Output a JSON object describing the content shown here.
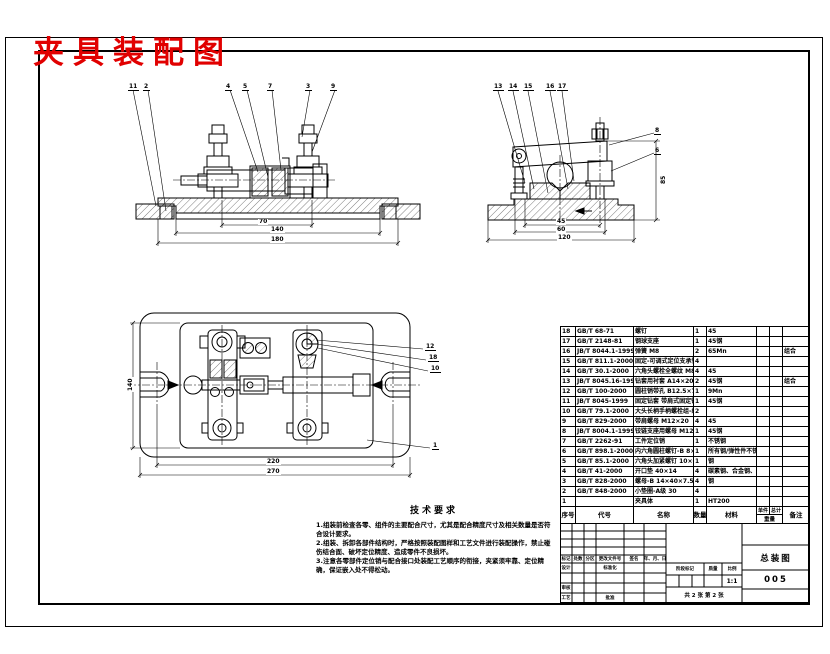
{
  "title": "夹具装配图",
  "title_color": "#e10000",
  "tech": {
    "heading": "技术要求",
    "items": [
      "1.组装前检查各零、组件的主要配合尺寸，尤其是配合精度尺寸及相关数量是否符合设计要求。",
      "2.组装、拆卸各部件结构时，严格按照装配图样和工艺文件进行装配操作，禁止碰伤结合面、破坏定位精度、造成零件不良损坏。",
      "3.注意各零部件定位销与配合接口处装配工艺顺序的衔接，夹紧须牢靠、定位精确，保证嵌入处不得松动。"
    ]
  },
  "bom": {
    "header": {
      "seq": "序号",
      "code": "代号",
      "name": "名称",
      "qty": "数量",
      "material": "材料",
      "unit": "单件",
      "total": "总计",
      "weight": "重量",
      "remark": "备注"
    },
    "rows": [
      {
        "seq": "18",
        "code": "GB/T 68-71",
        "name": "螺钉",
        "qty": "1",
        "material": "45",
        "unit": "",
        "total": "",
        "remark": ""
      },
      {
        "seq": "17",
        "code": "GB/T 2148-81",
        "name": "钢球支座",
        "qty": "1",
        "material": "45钢",
        "unit": "",
        "total": "",
        "remark": ""
      },
      {
        "seq": "16",
        "code": "JB/T 8044.1-1999",
        "name": "弹簧 M8",
        "qty": "2",
        "material": "65Mn",
        "unit": "",
        "total": "",
        "remark": "组合"
      },
      {
        "seq": "15",
        "code": "GB/T 811.1-2000",
        "name": "固定-可调式定位支承钉 B6×30",
        "qty": "4",
        "material": "",
        "unit": "",
        "total": "",
        "remark": ""
      },
      {
        "seq": "14",
        "code": "GB/T 30.1-2000",
        "name": "六角头螺栓全螺纹 M8×35",
        "qty": "4",
        "material": "45",
        "unit": "",
        "total": "",
        "remark": ""
      },
      {
        "seq": "13",
        "code": "JB/T 8045.16-1999",
        "name": "钻套用衬套 A14×20",
        "qty": "2",
        "material": "45钢",
        "unit": "",
        "total": "",
        "remark": "组合"
      },
      {
        "seq": "12",
        "code": "GB/T 100-2000",
        "name": "圆柱销带孔 B12.5×70",
        "qty": "1",
        "material": "9Mn",
        "unit": "",
        "total": "",
        "remark": ""
      },
      {
        "seq": "11",
        "code": "JB/T 8045-1999",
        "name": "固定钻套 带肩式固定钻套",
        "qty": "1",
        "material": "45钢",
        "unit": "",
        "total": "",
        "remark": ""
      },
      {
        "seq": "10",
        "code": "GB/T 79.1-2000",
        "name": "大头长柄手柄螺栓组-组 B8×L",
        "qty": "2",
        "material": "",
        "unit": "",
        "total": "",
        "remark": ""
      },
      {
        "seq": "9",
        "code": "GB/T 829-2000",
        "name": "带肩螺母 M12×20",
        "qty": "4",
        "material": "45",
        "unit": "",
        "total": "",
        "remark": ""
      },
      {
        "seq": "8",
        "code": "JB/T 8004.1-1999",
        "name": "铰链支座用螺母 M12",
        "qty": "1",
        "material": "45钢",
        "unit": "",
        "total": "",
        "remark": ""
      },
      {
        "seq": "7",
        "code": "GB/T 2262-91",
        "name": "工件定位销",
        "qty": "1",
        "material": "不锈钢",
        "unit": "",
        "total": "",
        "remark": ""
      },
      {
        "seq": "6",
        "code": "GB/T 898.1-2000",
        "name": "内六角圆柱螺钉-B 8×16-B",
        "qty": "1",
        "material": "所有钢/弹性件不锈钢",
        "unit": "",
        "total": "",
        "remark": ""
      },
      {
        "seq": "5",
        "code": "GB/T 85.1-2000",
        "name": "六角头加紧螺钉 10×60",
        "qty": "1",
        "material": "钢",
        "unit": "",
        "total": "",
        "remark": ""
      },
      {
        "seq": "4",
        "code": "GB/T 41-2000",
        "name": "开口垫 40×14",
        "qty": "4",
        "material": "碳素钢、合金钢、不锈钢",
        "unit": "",
        "total": "",
        "remark": ""
      },
      {
        "seq": "3",
        "code": "GB/T 828-2000",
        "name": "螺母-B 14×40×7.5×14.5",
        "qty": "4",
        "material": "钢",
        "unit": "",
        "total": "",
        "remark": ""
      },
      {
        "seq": "2",
        "code": "GB/T 848-2000",
        "name": "小垫圈-A级 30",
        "qty": "4",
        "material": "",
        "unit": "",
        "total": "",
        "remark": ""
      },
      {
        "seq": "1",
        "code": "",
        "name": "夹具体",
        "qty": "1",
        "material": "HT200",
        "unit": "",
        "total": "",
        "remark": ""
      }
    ]
  },
  "title_block": {
    "rev_cols": [
      "标记",
      "处数",
      "分区",
      "更改文件号",
      "签名",
      "年、月、日"
    ],
    "labels": {
      "design": "设计",
      "standardization": "标准化",
      "check": "审核",
      "process": "工艺",
      "approve": "批准",
      "stage": "阶段标记",
      "weight": "质量",
      "scale": "比例"
    },
    "scale_value": "1:1",
    "weight_value": "",
    "sheet_info": "共 2 张  第 2 张",
    "drawing_name": "总装图",
    "drawing_no": "005"
  },
  "annotations": {
    "balloons": [
      {
        "n": "11",
        "x": 128,
        "y": 83
      },
      {
        "n": "2",
        "x": 143,
        "y": 83
      },
      {
        "n": "4",
        "x": 225,
        "y": 83
      },
      {
        "n": "5",
        "x": 242,
        "y": 83
      },
      {
        "n": "7",
        "x": 267,
        "y": 83
      },
      {
        "n": "3",
        "x": 305,
        "y": 83
      },
      {
        "n": "9",
        "x": 330,
        "y": 83
      },
      {
        "n": "13",
        "x": 493,
        "y": 83
      },
      {
        "n": "14",
        "x": 508,
        "y": 83
      },
      {
        "n": "15",
        "x": 523,
        "y": 83
      },
      {
        "n": "16",
        "x": 545,
        "y": 83
      },
      {
        "n": "17",
        "x": 557,
        "y": 83
      },
      {
        "n": "8",
        "x": 654,
        "y": 127
      },
      {
        "n": "6",
        "x": 654,
        "y": 147
      },
      {
        "n": "12",
        "x": 425,
        "y": 343
      },
      {
        "n": "18",
        "x": 428,
        "y": 354
      },
      {
        "n": "10",
        "x": 430,
        "y": 365
      },
      {
        "n": "1",
        "x": 432,
        "y": 442
      }
    ],
    "dims": [
      {
        "t": "70",
        "x": 258,
        "y": 219
      },
      {
        "t": "140",
        "x": 270,
        "y": 227
      },
      {
        "t": "180",
        "x": 270,
        "y": 237
      },
      {
        "t": "85",
        "x": 661,
        "y": 185,
        "rot": true
      },
      {
        "t": "45",
        "x": 556,
        "y": 219
      },
      {
        "t": "60",
        "x": 556,
        "y": 227
      },
      {
        "t": "120",
        "x": 557,
        "y": 235
      },
      {
        "t": "220",
        "x": 266,
        "y": 459
      },
      {
        "t": "270",
        "x": 266,
        "y": 469
      },
      {
        "t": "140",
        "x": 128,
        "y": 392,
        "rot": true
      }
    ]
  }
}
